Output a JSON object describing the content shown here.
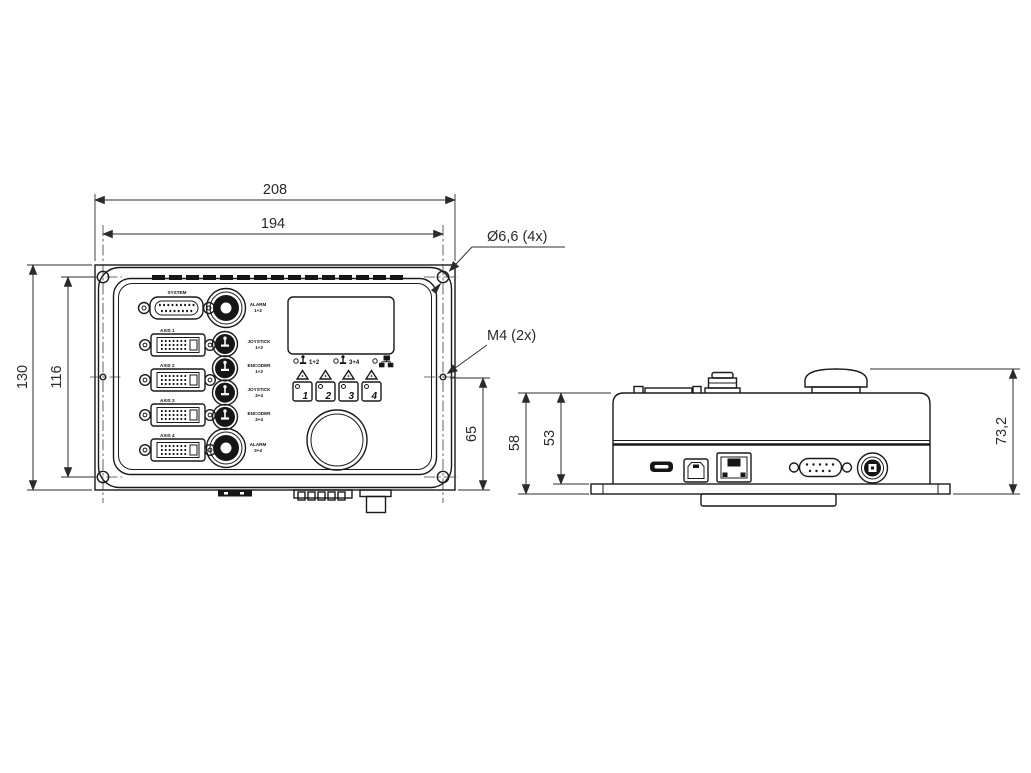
{
  "colors": {
    "line": "#1a1a1a",
    "dim_text": "#2a2a2a",
    "dark_fill": "#161616",
    "background": "#ffffff"
  },
  "dimensions": {
    "overall_width": "208",
    "hole_spacing_horizontal": "194",
    "overall_height": "130",
    "hole_spacing_vertical": "116",
    "side_hole_height": "65",
    "body_depth": "58",
    "lid_depth": "53",
    "total_depth": "73,2"
  },
  "callouts": {
    "mounting_hole": "Ø6,6 (4x)",
    "thread_hole": "M4 (2x)"
  },
  "front_panel": {
    "system_connector_label": "SYSTEM",
    "axis_connectors": [
      {
        "label": "AXIS 1"
      },
      {
        "label": "AXIS 2"
      },
      {
        "label": "AXIS 3"
      },
      {
        "label": "AXIS 4"
      }
    ],
    "round_connectors": [
      {
        "line1": "ALARM",
        "line2": "1+2"
      },
      {
        "line1": "JOYSTICK",
        "line2": "1+2"
      },
      {
        "line1": "ENCODER",
        "line2": "1+2"
      },
      {
        "line1": "JOYSTICK",
        "line2": "3+4"
      },
      {
        "line1": "ENCODER",
        "line2": "3+4"
      },
      {
        "line1": "ALARM",
        "line2": "3+4"
      }
    ],
    "led_labels": [
      {
        "label": "1+2"
      },
      {
        "label": "3+4"
      }
    ],
    "channel_buttons": [
      {
        "label": "1"
      },
      {
        "label": "2"
      },
      {
        "label": "3"
      },
      {
        "label": "4"
      }
    ]
  }
}
